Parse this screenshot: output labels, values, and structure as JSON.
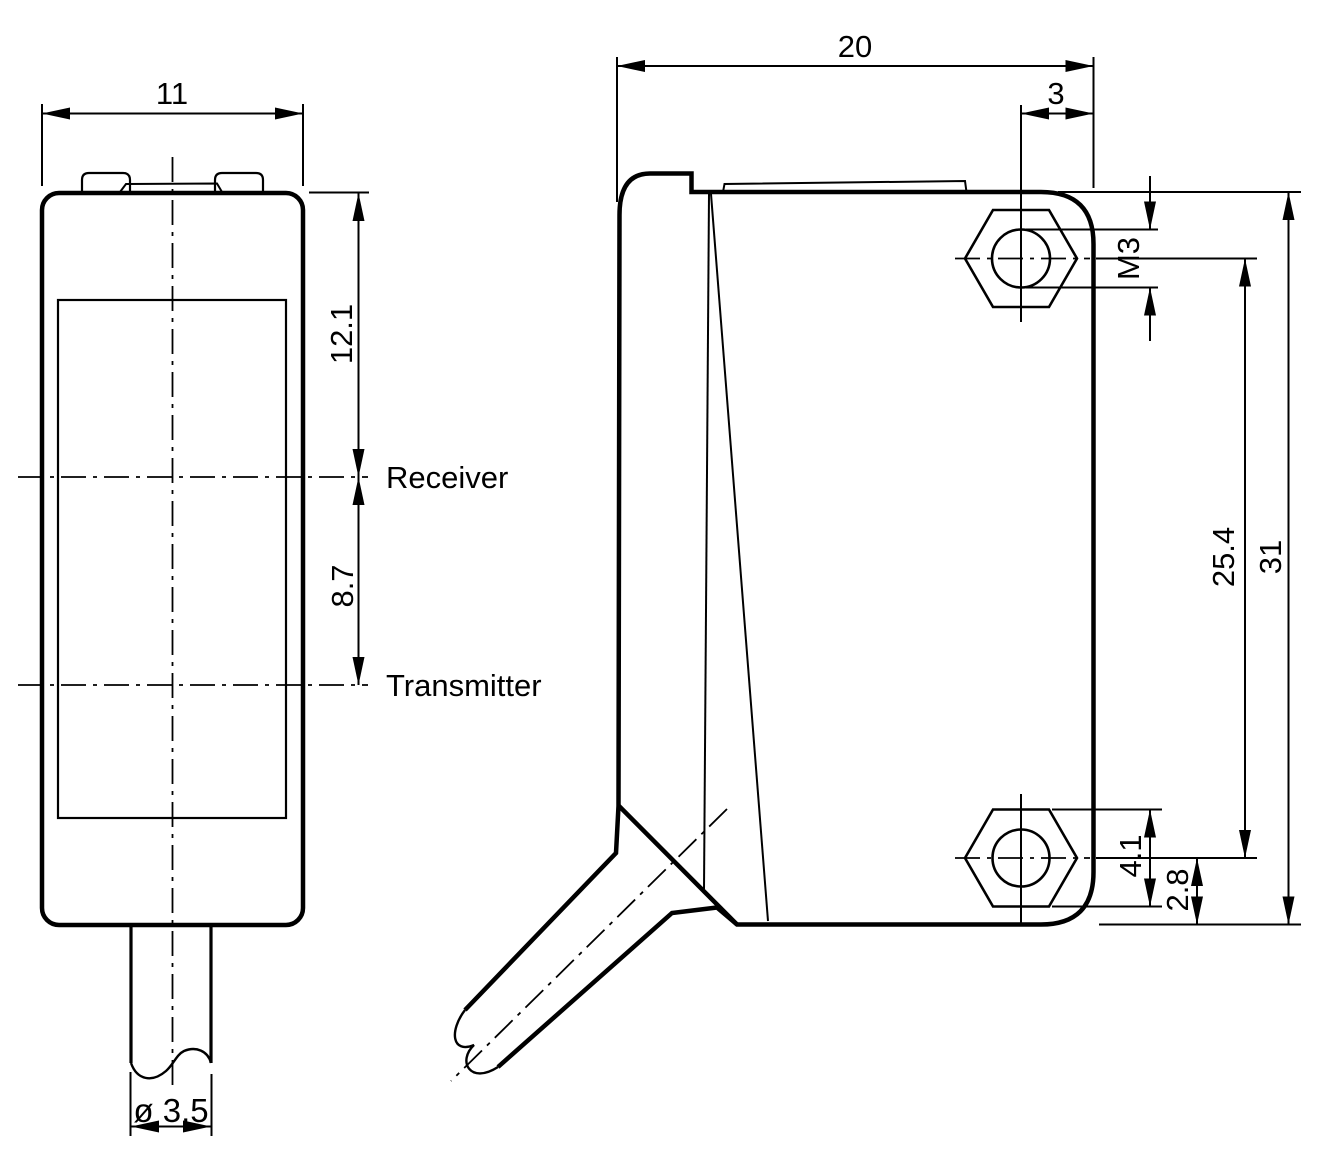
{
  "drawing": {
    "title": "Photoelectric sensor dimensional drawing",
    "units": "mm",
    "front_view": {
      "dim_width": "11",
      "dim_receiver_from_top": "12.1",
      "dim_receiver_to_transmitter": "8.7",
      "label_receiver": "Receiver",
      "label_transmitter": "Transmitter",
      "dim_cable_diameter": "ø 3.5"
    },
    "side_view": {
      "dim_depth": "20",
      "dim_hole_to_rear": "3",
      "dim_thread": "M3",
      "dim_hole_spacing": "25.4",
      "dim_height": "31",
      "dim_nut_across_flats": "4.1",
      "dim_hole_to_bottom": "2.8"
    }
  }
}
